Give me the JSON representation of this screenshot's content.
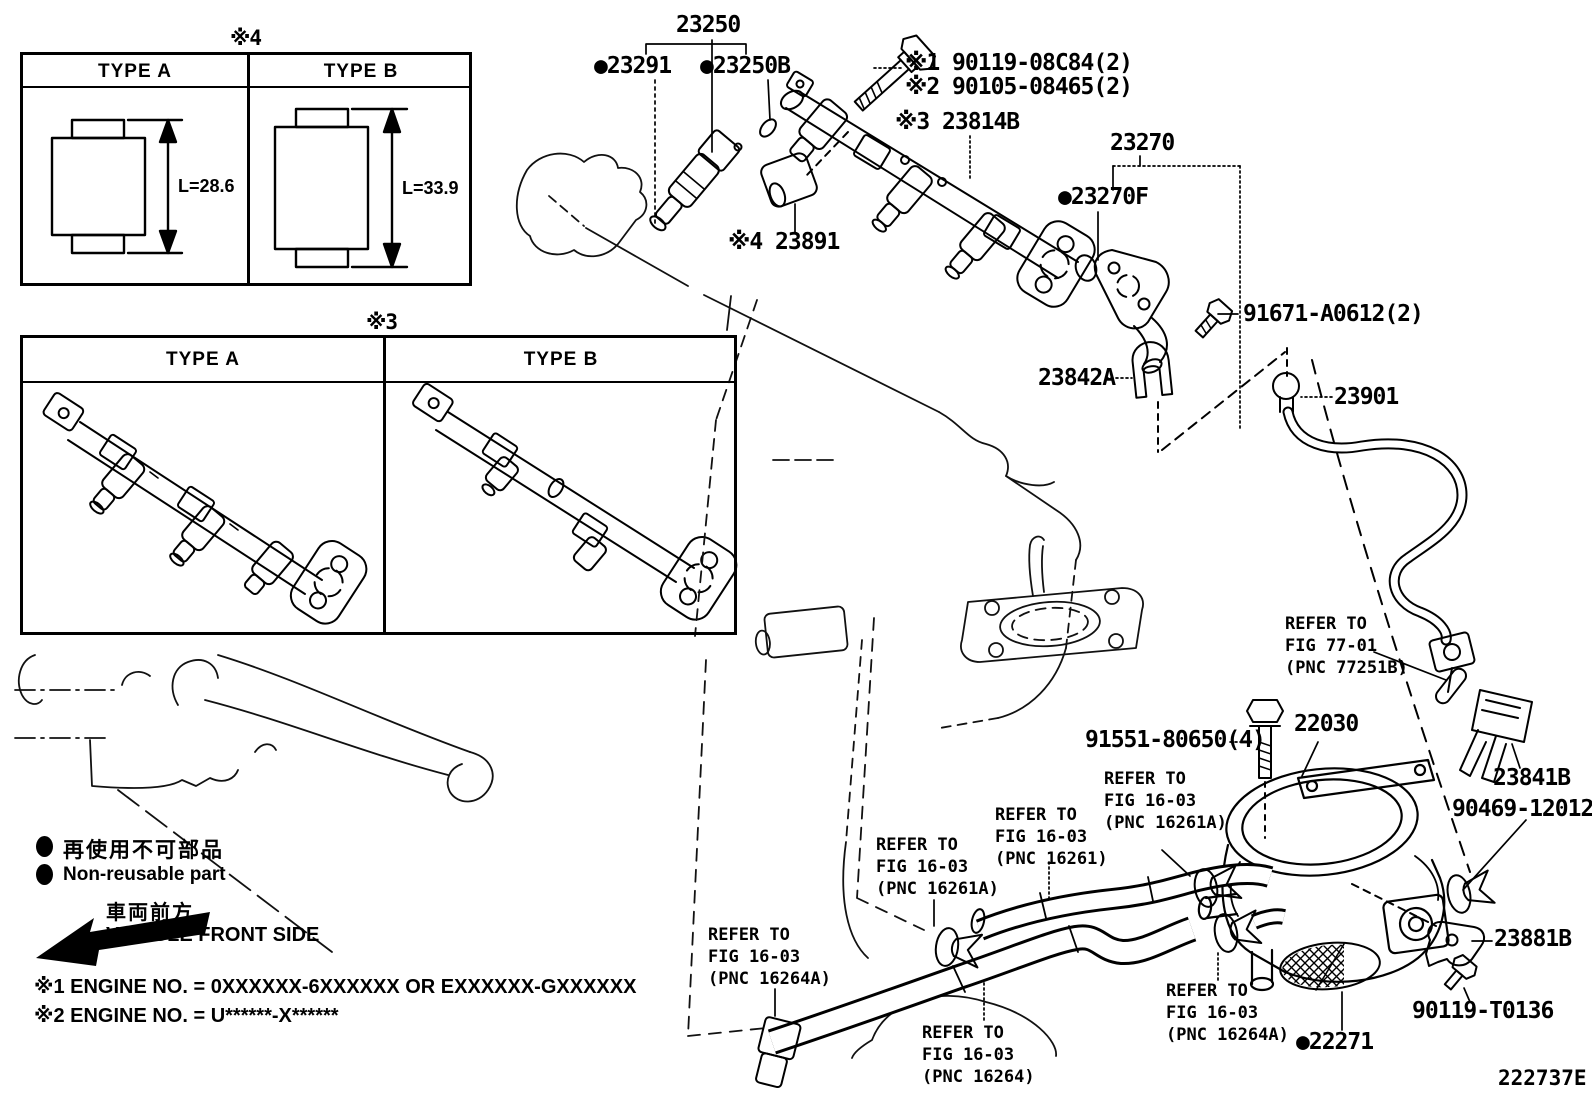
{
  "diagram_code": "222737E",
  "insets": {
    "injector_types": {
      "marker": "※4",
      "type_a": {
        "title": "TYPE A",
        "dimension": "L=28.6"
      },
      "type_b": {
        "title": "TYPE B",
        "dimension": "L=33.9"
      }
    },
    "rail_types": {
      "marker": "※3",
      "type_a": {
        "title": "TYPE A"
      },
      "type_b": {
        "title": "TYPE B"
      }
    }
  },
  "legend": {
    "non_reusable_jp": "再使用不可部品",
    "non_reusable_en": "Non-reusable part",
    "vehicle_front_jp": "車両前方",
    "vehicle_front_en": "VEHICLE FRONT SIDE"
  },
  "notes": {
    "note1": "※1 ENGINE NO. = 0XXXXXX-6XXXXXX OR EXXXXXX-GXXXXXX",
    "note2": "※2 ENGINE NO. = U******-X******"
  },
  "part_labels": {
    "p23250": "23250",
    "p23291": "●23291",
    "p23250B": "●23250B",
    "p90119_08C84": "※1 90119-08C84(2)",
    "p90105_08465": "※2 90105-08465(2)",
    "p23814B": "※3 23814B",
    "p23270": "23270",
    "p23270F": "●23270F",
    "p23891": "※4 23891",
    "p91671": "91671-A0612(2)",
    "p23842A": "23842A",
    "p23901": "23901",
    "p22030": "22030",
    "p23841B": "23841B",
    "p90469": "90469-12012",
    "p91551": "91551-80650(4)",
    "p23881B": "23881B",
    "p90119_T0136": "90119-T0136",
    "p22271": "●22271"
  },
  "refer_notes": {
    "fig77_01": "REFER TO\nFIG 77-01\n(PNC 77251B)",
    "fig16_03_16261a_right": "REFER TO\nFIG 16-03\n(PNC 16261A)",
    "fig16_03_16261": "REFER TO\nFIG 16-03\n(PNC 16261)",
    "fig16_03_16261a_left": "REFER TO\nFIG 16-03\n(PNC 16261A)",
    "fig16_03_16264a_left": "REFER TO\nFIG 16-03\n(PNC 16264A)",
    "fig16_03_16264": "REFER TO\nFIG 16-03\n(PNC 16264)",
    "fig16_03_16264a_right": "REFER TO\nFIG 16-03\n(PNC 16264A)"
  }
}
